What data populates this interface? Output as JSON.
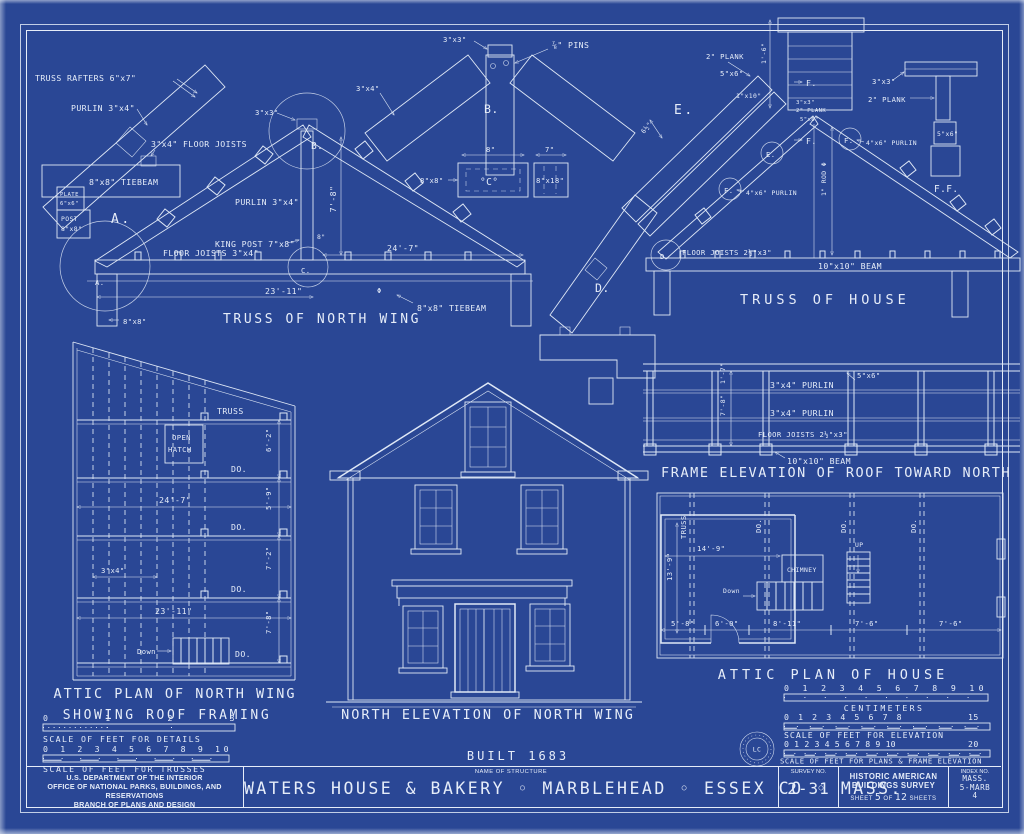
{
  "colors": {
    "paper": "#2a4795",
    "ink": "#e6edf9"
  },
  "truss_a": {
    "rafters_label": "TRUSS RAFTERS 6\"x7\"",
    "purlin_label": "PURLIN 3\"x4\"",
    "joists_arrow_label": "3\"x4\" FLOOR JOISTS",
    "plate_l1": "PLATE",
    "plate_l2": "6\"x6\"",
    "post_l1": "POST",
    "post_l2": "8\"x8\"",
    "tiebeam_label": "8\"x8\" TIEBEAM",
    "a_big": "A.",
    "a_circle": "A.",
    "b_circle": "B.",
    "c_circle": "C.",
    "apex_size": "3\"x3\"",
    "purlin2_label": "PURLIN 3\"x4\"",
    "dim_rise": "7'-8\"",
    "kingpost_label": "KING POST 7\"x8\"",
    "kingpost_width": "8\"",
    "joists_label": "FLOOR JOISTS 3\"x4\"",
    "dim_span_right": "24'-7\"",
    "dim_span_left": "23'-11\"",
    "phi": "Φ",
    "tiebeam2_label": "8\"x8\" TIEBEAM",
    "post_size": "8\"x8\"",
    "caption": "TRUSS OF NORTH WING"
  },
  "detail_b": {
    "apex_size": "3\"x3\"",
    "pins": "⅞\" PINS",
    "label": "B.",
    "rafter_size": "3\"x4\"",
    "dim8": "8\"",
    "dim7": "7\"",
    "sec1_size": "8\"x8\"",
    "sec1": "°C°",
    "sec2": "8\"x18\""
  },
  "detail_d": {
    "label": "D."
  },
  "truss_h": {
    "plank1": "2\" PLANK",
    "size56": "5\"x6\"",
    "e_big": "E.",
    "dim65": "6½\"",
    "board1x10": "1\"x10\"",
    "e_circle": "E.",
    "f_circle1": "F.",
    "purlin_left": "4\"x6\" PURLIN",
    "f_circle2": "F.",
    "purlin_right": "4\"x6\" PURLIN",
    "apex_3x3": "3\"x3\"",
    "apex_plank": "2\" PLANK",
    "apex_56": "5\"x6\"",
    "f_ref1": "F.",
    "f_ref2": "F.",
    "dim16": "1'-6\"",
    "rod_label": "1\" ROD Φ",
    "d_circle": "D.",
    "joists_label": "FLOOR JOISTS 2½\"x3\"",
    "beam_label": "10\"x10\" BEAM",
    "caption": "TRUSS OF HOUSE",
    "ff_33": "3\"x3\"",
    "ff_plank": "2\" PLANK",
    "ff_56": "5\"x6\"",
    "ff_caption": "F.F."
  },
  "frame_e": {
    "plate": "5\"x6\"",
    "purlin1": "3\"x4\" PURLIN",
    "purlin2": "3\"x4\" PURLIN",
    "joists": "FLOOR JOISTS 2½\"x3\"",
    "beam": "10\"x10\" BEAM",
    "dim17": "1'-7\"",
    "dim78": "7'-8\"",
    "caption": "FRAME ELEVATION OF ROOF TOWARD NORTH"
  },
  "attic_n": {
    "truss": "TRUSS",
    "do": "DO.",
    "hatch1": "OPEN",
    "hatch2": "HATCH",
    "dim247": "24'-7\"",
    "dim2311": "23'-11\"",
    "dim62": "6'-2\"",
    "dim59": "5'-9\"",
    "dim72": "7'-2\"",
    "dim78": "7'-8\"",
    "dim34": "3\"x4\"",
    "down": "Down",
    "caption1": "ATTIC PLAN OF NORTH WING",
    "caption2": "SHOWING ROOF FRAMING"
  },
  "elevation": {
    "caption": "NORTH ELEVATION OF NORTH WING",
    "built": "BUILT 1683"
  },
  "attic_h": {
    "truss": "TRUSS",
    "do": "DO.",
    "chimney": "CHIMNEY",
    "down": "Down",
    "up": "UP",
    "dim149": "14'-9\"",
    "dim139": "13'-9\"",
    "dims_bottom": [
      "5'-8\"",
      "6'-0\"",
      "8'-11\"",
      "7'-6\"",
      "7'-6\""
    ],
    "caption": "ATTIC PLAN OF HOUSE"
  },
  "scales": {
    "details": {
      "numbers": "0 1 2 3",
      "caption": "SCALE OF FEET FOR DETAILS"
    },
    "trusses": {
      "numbers": "0 1 2 3 4 5 6 7 8 9 10",
      "caption": "SCALE OF FEET FOR TRUSSES"
    },
    "centimeters": {
      "numbers": "0 1 2 3 4 5 6 7 8 9 10",
      "caption": "CENTIMETERS"
    },
    "elevation": {
      "numbers": "0 1 2 3 4 5 6 7 8",
      "end": "15",
      "caption": "SCALE OF FEET FOR ELEVATION"
    },
    "plans": {
      "numbers": "0 1 2 3 4 5 6 7 8 9 10",
      "end": "20",
      "caption": "SCALE OF FEET FOR PLANS & FRAME ELEVATION"
    }
  },
  "stamp": "LC",
  "title_block": {
    "agency_line1": "U.S. DEPARTMENT OF THE INTERIOR",
    "agency_line2": "OFFICE OF NATIONAL PARKS, BUILDINGS, AND RESERVATIONS",
    "agency_line3": "BRANCH OF PLANS AND DESIGN",
    "name_label": "NAME OF STRUCTURE",
    "structure_name": "WATERS HOUSE & BAKERY ◦ MARBLEHEAD ◦ ESSEX CO ◦ MASS.",
    "survey_label": "SURVEY NO.",
    "survey_no": "2-31",
    "habs_line1": "HISTORIC AMERICAN",
    "habs_line2": "BUILDINGS SURVEY",
    "sheet_label": "SHEET",
    "sheet_no": "5",
    "of_label": "OF",
    "sheet_total": "12",
    "sheets_label": "SHEETS",
    "index_label": "INDEX NO.",
    "index_l1": "MASS.",
    "index_l2": "5-MARB",
    "index_l3": "4"
  }
}
